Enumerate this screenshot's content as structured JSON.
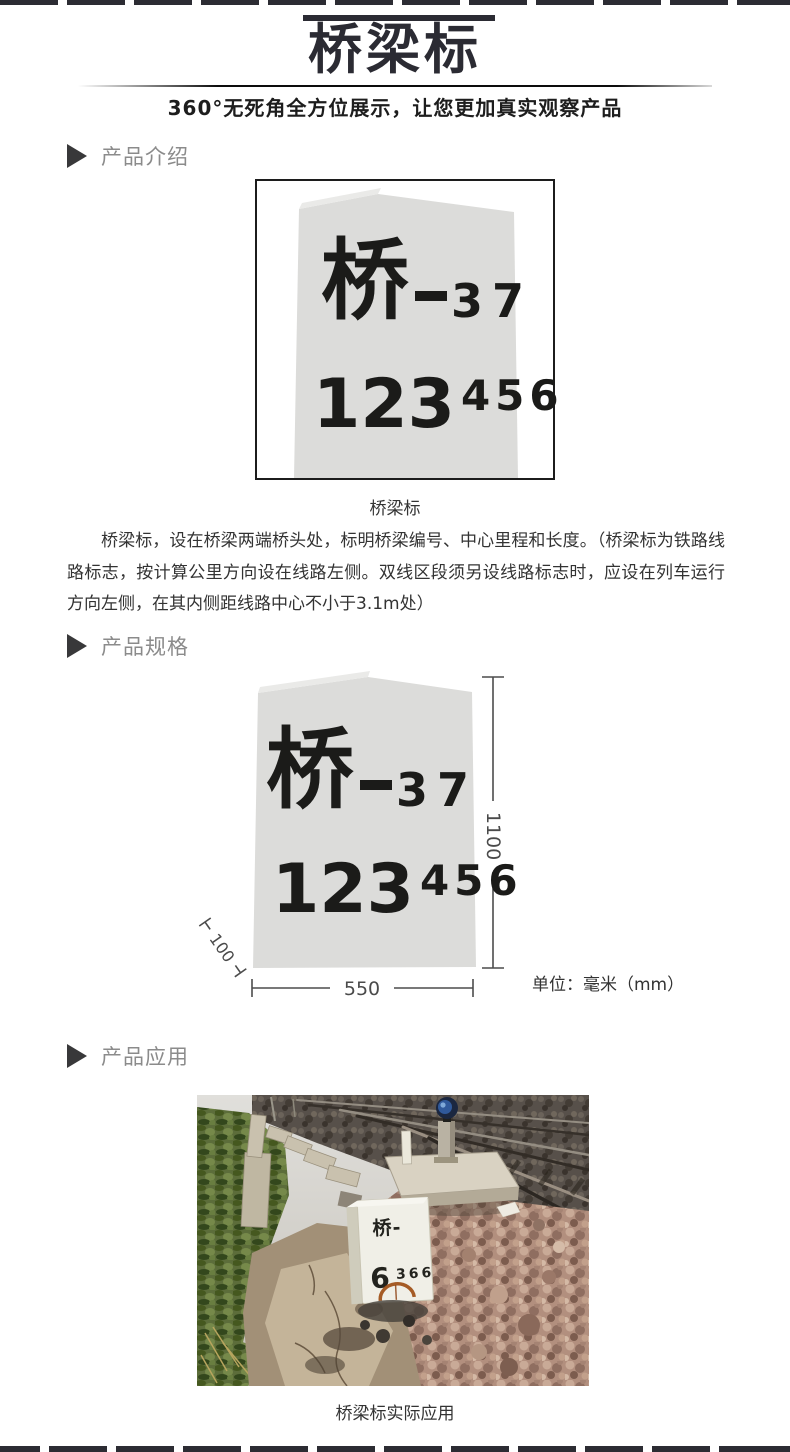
{
  "header": {
    "title": "桥梁标",
    "subtitle": "360°无死角全方位展示，让您更加真实观察产品"
  },
  "sections": {
    "intro": {
      "label": "产品介绍"
    },
    "spec": {
      "label": "产品规格"
    },
    "application": {
      "label": "产品应用"
    }
  },
  "stone": {
    "char": "桥",
    "dash": "—",
    "serial": "37",
    "mileage_large": "123",
    "mileage_small": "456"
  },
  "intro": {
    "caption": "桥梁标",
    "description": "桥梁标，设在桥梁两端桥头处，标明桥梁编号、中心里程和长度。（桥梁标为铁路线路标志，按计算公里方向设在线路左侧。双线区段须另设线路标志时，应设在列车运行方向左侧，在其内侧距线路中心不小于3.1m处）"
  },
  "spec": {
    "height_mm": "1100",
    "width_mm": "550",
    "thickness_mm": "100",
    "unit": "单位：毫米（mm）"
  },
  "application": {
    "caption": "桥梁标实际应用",
    "photo_stone": {
      "top": "桥-",
      "digit": "6",
      "digits_small": "366"
    }
  },
  "colors": {
    "title": "#2b2b33",
    "section_label": "#8b8b8b",
    "body_text": "#333333",
    "stone_fill": "#dcdcda",
    "stone_text": "#1b1b19",
    "dimension_line": "#4c4c4c"
  }
}
